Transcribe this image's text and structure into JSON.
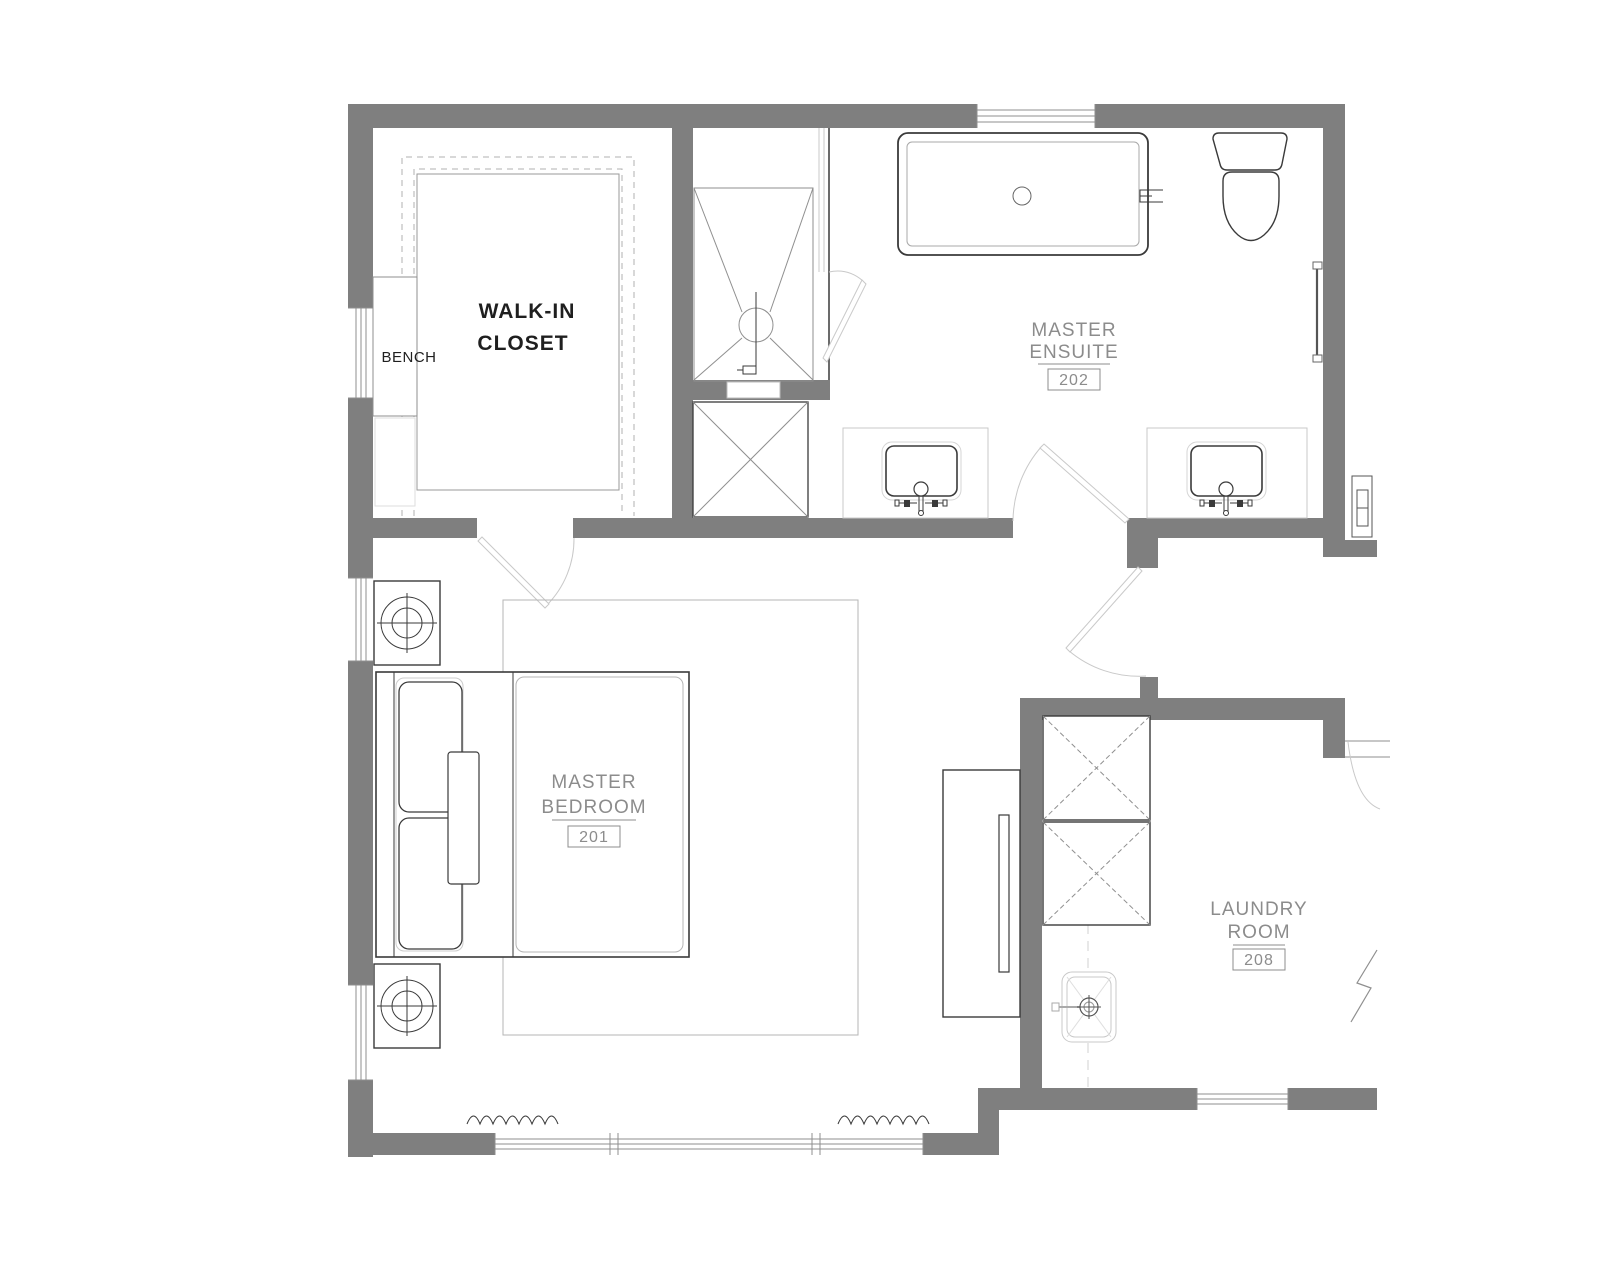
{
  "colors": {
    "paper": "#ffffff",
    "wall_fill": "#7f7f7f",
    "line_dark": "#3a3a3a",
    "line_mid": "#8f8f8f",
    "line_light": "#c9c9c9",
    "label_gray": "#8c8c8c",
    "text_dark": "#1f1f1f"
  },
  "rooms": {
    "walk_in_closet": {
      "line1": "WALK-IN",
      "line2": "CLOSET"
    },
    "master_ensuite": {
      "line1": "MASTER",
      "line2": "ENSUITE",
      "number": "202"
    },
    "master_bedroom": {
      "line1": "MASTER",
      "line2": "BEDROOM",
      "number": "201"
    },
    "laundry_room": {
      "line1": "LAUNDRY",
      "line2": "ROOM",
      "number": "208"
    }
  },
  "annotations": {
    "bench": "BENCH"
  },
  "fixtures": [
    "bathtub",
    "toilet",
    "double-vanity-sinks",
    "walk-in-shower",
    "linen-cabinet",
    "towel-bar",
    "electrical-panel",
    "king-bed",
    "nightstand-lamps",
    "area-rug",
    "tv-console",
    "washer",
    "dryer",
    "utility-sink",
    "bench",
    "closet-shelving",
    "windows",
    "swing-doors",
    "drapery-symbols",
    "break-line"
  ]
}
